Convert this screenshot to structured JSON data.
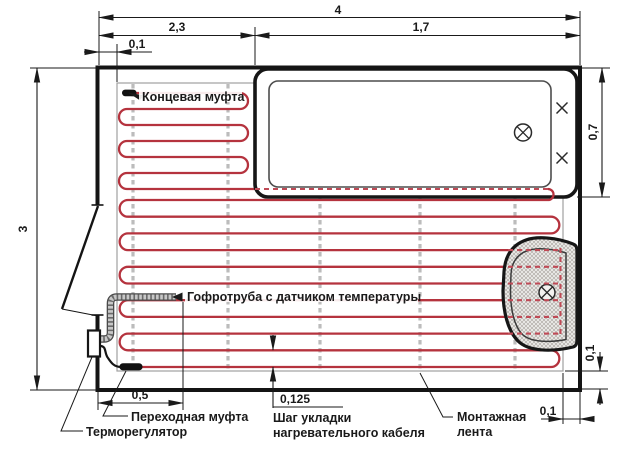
{
  "diagram": {
    "type": "floor-heating-cable-layout-plan",
    "colors": {
      "cable_red": "#b5333e",
      "cable_hidden_red": "#bf4a56",
      "mounting_tape_gray": "#bcbcbc",
      "wall_black": "#141414",
      "heated_area_boundary_gray": "#a0a0a0"
    },
    "dimensions": {
      "room_width_total": "4",
      "room_width_left": "2,3",
      "room_width_right": "1,7",
      "cable_edge_offset_top": "0,1",
      "room_height": "3",
      "bathtub_width": "0,7",
      "cable_edge_offset_right": "0,1",
      "sensor_tube_length": "0,5",
      "cable_step": "0,125",
      "cable_edge_offset_bottom": "0,1"
    },
    "labels": {
      "end_coupling": "Концевая муфта",
      "sensor_tube": "Гофротруба с датчиком температуры",
      "transition_coupling": "Переходная муфта",
      "thermostat": "Терморегулятор",
      "cable_step_caption_line1": "Шаг укладки",
      "cable_step_caption_line2": "нагревательного кабеля",
      "mounting_tape_line1": "Монтажная",
      "mounting_tape_line2": "лента"
    },
    "icons": [
      "drain-icon",
      "tap-cross-icon"
    ]
  }
}
